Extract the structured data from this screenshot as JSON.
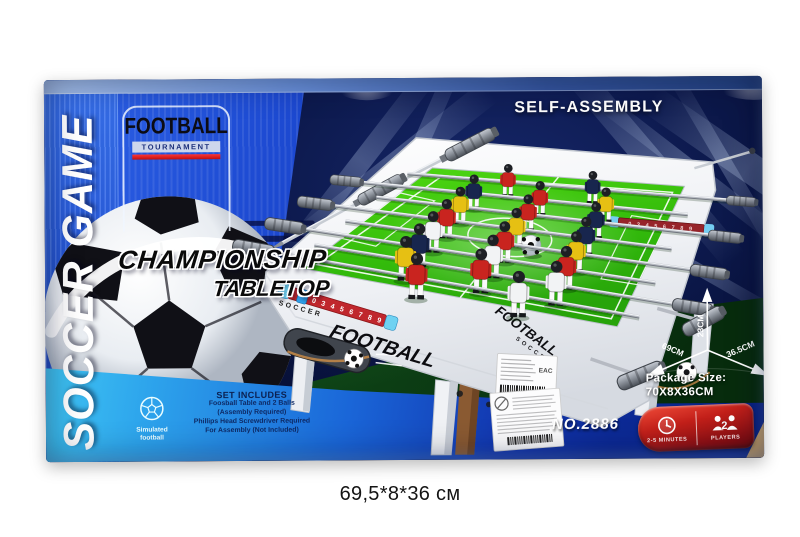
{
  "caption": "69,5*8*36 см",
  "panel_left": {
    "vertical_title": "SOCCER GAME",
    "logo_line1": "FOOTBALL",
    "logo_line2": "TOURNAMENT",
    "headline1": "CHAMPIONSHIP",
    "headline2": "TABLETOP",
    "includes_title": "SET INCLUDES",
    "includes_line1": "Foosball Table and 2 Balls",
    "includes_line2": "(Assembly Required)",
    "includes_line3": "Phillips Head Screwdriver Required",
    "includes_line4": "For Assembly (Not Included)",
    "simulated_line1": "Simulated",
    "simulated_line2": "football"
  },
  "panel_right": {
    "self_assembly": "SELF-ASSEMBLY",
    "dim_height": "23CM",
    "dim_length": "69CM",
    "dim_width": "36.5CM",
    "package_label": "Package Size:",
    "package_value": "70X8X36CM",
    "item_no": "NO.2886",
    "minutes_label": "2-5 MINUTES",
    "players_label": "PLAYERS",
    "players_count": "2"
  },
  "table_art": {
    "front_brand_small": "SOCCER",
    "front_brand_large": "FOOTBALL",
    "end_brand_large": "FOOTBALL",
    "end_brand_small": "SOCCER",
    "score_strip_digits": "0 3 4 5 6 7 8 9",
    "eac_mark": "EAC"
  },
  "colors": {
    "box_blue": "#1d4ad2",
    "band_bright_blue": "#2e63e8",
    "dark_navy": "#081243",
    "band_cyan": "#49d6f7",
    "band_deep_blue": "#0a2488",
    "grass_green": "#0e4517",
    "pitch_green": "#38c70c",
    "badge_red": "#c3201a",
    "team_red": "#c9241f",
    "team_navy": "#18264e",
    "team_yellow": "#e6c013",
    "team_white": "#f2f3f5"
  }
}
